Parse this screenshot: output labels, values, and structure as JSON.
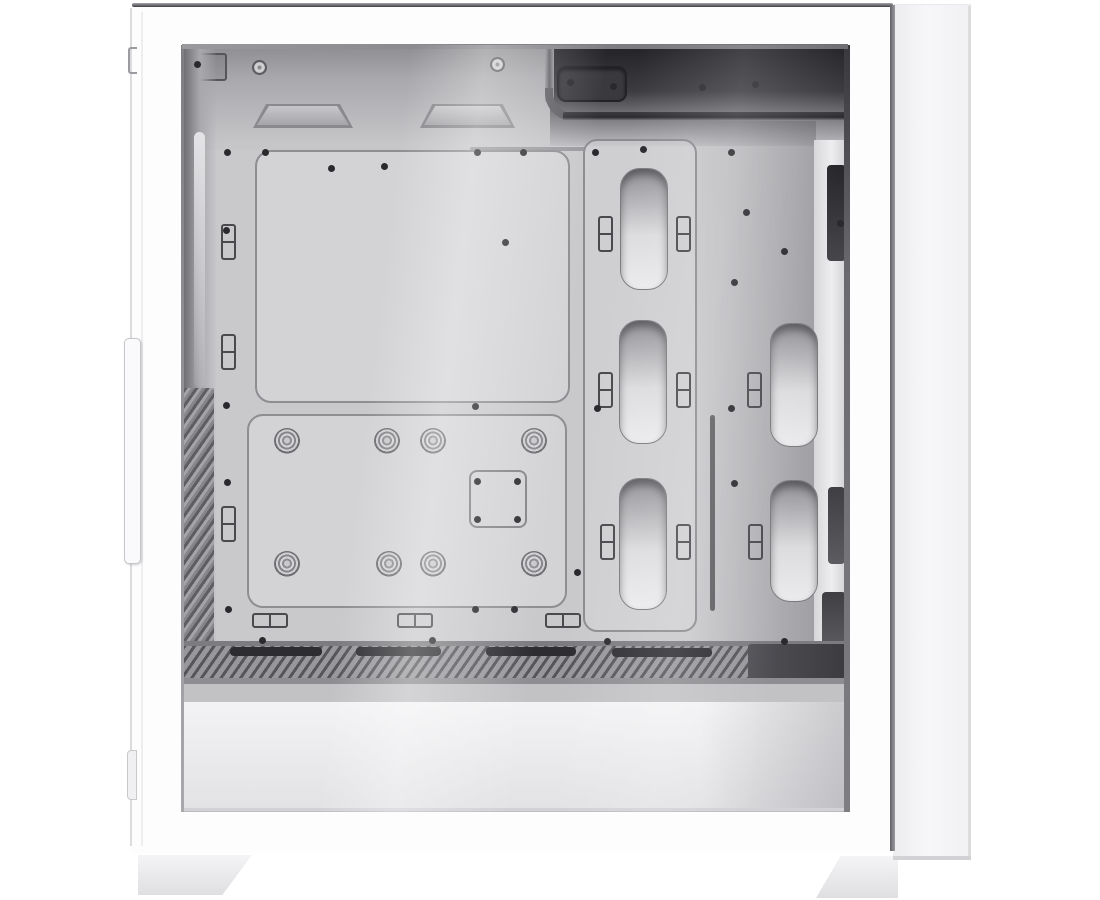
{
  "meta": {
    "label": "White mid-tower PC case, side view product photo with tempered glass panel showing empty interior: motherboard tray with standoffs, cable routing cutouts, PSU shroud with vent, and two white feet",
    "background": "#ffffff"
  },
  "palette": {
    "case_white": "#fdfdfe",
    "interior_gray": "#c9c9cc",
    "top_shadow": "#232327",
    "vent_dark": "#55555a",
    "slot_dark": "#2d2d31",
    "edge_dark": "#3f3f43"
  },
  "parts": [
    {
      "n": "rear-exterior-panel",
      "c": "rear-panel",
      "b": [
        893,
        4,
        78,
        856
      ]
    },
    {
      "n": "rear-panel-right-edge",
      "c": "edge-light",
      "b": [
        968,
        6,
        3,
        850
      ]
    },
    {
      "n": "side-frame",
      "c": "case-body",
      "b": [
        130,
        4,
        765,
        849
      ]
    },
    {
      "n": "case-top-edge",
      "c": "edge-dark-h",
      "b": [
        132,
        3,
        761,
        4
      ]
    },
    {
      "n": "case-right-edge",
      "c": "edge-dark-v",
      "b": [
        890,
        5,
        5,
        846
      ]
    },
    {
      "n": "case-left-edge",
      "c": "edge-light",
      "b": [
        130,
        8,
        2,
        838
      ]
    },
    {
      "n": "front-panel-seam",
      "c": "seam",
      "b": [
        141,
        12,
        2,
        834
      ]
    },
    {
      "n": "tempered-glass",
      "c": "glass",
      "b": [
        182,
        45,
        668,
        767
      ]
    },
    {
      "n": "interior-top-left",
      "c": "band-left",
      "b": [
        183,
        46,
        367,
        104
      ]
    },
    {
      "n": "interior-top-right",
      "c": "band-right",
      "b": [
        550,
        46,
        297,
        100
      ]
    },
    {
      "n": "front-io-bracket",
      "c": "bracket-dark",
      "b": [
        189,
        53,
        38,
        28
      ]
    },
    {
      "n": "thumbscrew",
      "c": "screw-big",
      "b": [
        252,
        60,
        15,
        15
      ]
    },
    {
      "n": "thumbscrew",
      "c": "screw-big",
      "b": [
        490,
        57,
        15,
        15
      ]
    },
    {
      "n": "top-fan-rail",
      "c": "trap-out",
      "b": [
        253,
        104,
        100,
        24
      ]
    },
    {
      "n": "top-fan-rail-face",
      "c": "trap-in",
      "b": [
        257,
        106,
        92,
        19
      ]
    },
    {
      "n": "top-fan-rail",
      "c": "trap-out",
      "b": [
        420,
        104,
        95,
        24
      ]
    },
    {
      "n": "top-fan-rail-face",
      "c": "trap-in",
      "b": [
        424,
        106,
        87,
        19
      ]
    },
    {
      "n": "top-cable-cutout",
      "c": "slot-dark",
      "b": [
        557,
        66,
        70,
        36
      ]
    },
    {
      "n": "cable-channel-line",
      "c": "chan-line",
      "b": [
        470,
        147,
        115,
        4
      ]
    },
    {
      "n": "cable-channel-vertical",
      "c": "tube",
      "b": [
        545,
        44,
        9,
        58
      ]
    },
    {
      "n": "cable-channel-elbow",
      "c": "elbow",
      "b": [
        545,
        88,
        28,
        33
      ]
    },
    {
      "n": "cable-channel-ridge",
      "c": "ridge",
      "b": [
        563,
        112,
        283,
        9
      ]
    },
    {
      "n": "front-interior-column",
      "c": "front-col",
      "b": [
        183,
        46,
        34,
        610
      ]
    },
    {
      "n": "front-column-highlight",
      "c": "strip-light",
      "b": [
        194,
        132,
        11,
        255
      ]
    },
    {
      "n": "front-vent-slats",
      "c": "slats",
      "b": [
        184,
        388,
        30,
        264
      ]
    },
    {
      "n": "rear-shadow",
      "c": "shade-right",
      "b": [
        690,
        121,
        126,
        522
      ]
    },
    {
      "n": "rear-wall-highlight",
      "c": "bright-band",
      "b": [
        814,
        140,
        32,
        503
      ]
    },
    {
      "n": "mb-tray-upper-plate",
      "c": "plate",
      "b": [
        255,
        150,
        315,
        253
      ]
    },
    {
      "n": "mb-tray-lower-plate",
      "c": "plate",
      "b": [
        247,
        414,
        320,
        194
      ]
    },
    {
      "n": "cable-cutout-column",
      "c": "col-outline",
      "b": [
        583,
        139,
        114,
        493
      ]
    },
    {
      "n": "cable-cutout",
      "c": "cutout",
      "b": [
        620,
        168,
        48,
        122
      ]
    },
    {
      "n": "cable-cutout",
      "c": "cutout",
      "b": [
        619,
        320,
        48,
        124
      ]
    },
    {
      "n": "cable-cutout",
      "c": "cutout",
      "b": [
        619,
        478,
        48,
        132
      ]
    },
    {
      "n": "cable-cutout",
      "c": "cutout",
      "b": [
        770,
        323,
        48,
        124
      ]
    },
    {
      "n": "cable-cutout",
      "c": "cutout",
      "b": [
        770,
        480,
        48,
        122
      ]
    },
    {
      "n": "cable-slit",
      "c": "slit",
      "b": [
        710,
        415,
        5,
        196
      ]
    },
    {
      "n": "cpu-cooler-bracket",
      "c": "sq-bracket",
      "b": [
        469,
        470,
        58,
        58
      ]
    },
    {
      "n": "rear-latch-bar",
      "c": "bar-dark",
      "b": [
        827,
        165,
        19,
        96
      ]
    },
    {
      "n": "rear-latch-bar",
      "c": "bar-dark2",
      "b": [
        828,
        487,
        17,
        77
      ]
    },
    {
      "n": "rear-latch-bar",
      "c": "bar-dark2",
      "b": [
        822,
        592,
        24,
        56
      ]
    },
    {
      "n": "shroud-step",
      "c": "step",
      "b": [
        183,
        641,
        663,
        5
      ]
    },
    {
      "n": "psu-shroud-vent",
      "c": "hatch",
      "b": [
        183,
        646,
        663,
        32
      ]
    },
    {
      "n": "shroud-vent-slot",
      "c": "slot-dark2",
      "b": [
        230,
        647,
        92,
        9
      ]
    },
    {
      "n": "shroud-vent-slot",
      "c": "slot-dark2",
      "b": [
        356,
        647,
        85,
        9
      ]
    },
    {
      "n": "shroud-vent-slot",
      "c": "slot-dark2",
      "b": [
        486,
        647,
        90,
        9
      ]
    },
    {
      "n": "shroud-vent-slot",
      "c": "slot-dark2",
      "b": [
        612,
        648,
        100,
        9
      ]
    },
    {
      "n": "shroud-rear-shadow",
      "c": "block-dark",
      "b": [
        748,
        644,
        98,
        34
      ]
    },
    {
      "n": "shroud-under-line",
      "c": "under-line",
      "b": [
        183,
        678,
        663,
        6
      ]
    },
    {
      "n": "shroud-top-band",
      "c": "band-gray",
      "b": [
        183,
        684,
        663,
        18
      ]
    },
    {
      "n": "psu-shroud-face",
      "c": "shroud-face",
      "b": [
        183,
        702,
        663,
        108
      ]
    },
    {
      "n": "shroud-face-shadow",
      "c": "shade-right2",
      "b": [
        700,
        702,
        146,
        108
      ]
    },
    {
      "n": "glass-bottom-edge",
      "c": "edge-light2",
      "b": [
        183,
        808,
        663,
        3
      ]
    },
    {
      "n": "glass-left-edge",
      "c": "glass-edge-l",
      "b": [
        181,
        45,
        3,
        767
      ]
    },
    {
      "n": "glass-right-edge",
      "c": "glass-edge-r",
      "b": [
        844,
        45,
        6,
        767
      ]
    },
    {
      "n": "glass-top-edge",
      "c": "glass-edge-t",
      "b": [
        182,
        44,
        666,
        5
      ]
    },
    {
      "n": "left-foot",
      "c": "foot foot-l",
      "b": [
        138,
        855,
        114,
        40
      ]
    },
    {
      "n": "right-foot",
      "c": "foot foot-r",
      "b": [
        816,
        856,
        82,
        42
      ]
    },
    {
      "n": "rear-panel-bottom-edge",
      "c": "edge-light2",
      "b": [
        893,
        856,
        78,
        4
      ]
    },
    {
      "n": "front-panel-notch",
      "c": "notch",
      "b": [
        128,
        47,
        9,
        27
      ]
    },
    {
      "n": "front-panel-trim",
      "c": "f-plate",
      "b": [
        124,
        338,
        17,
        226
      ]
    },
    {
      "n": "front-panel-tab",
      "c": "f-tab",
      "b": [
        127,
        750,
        10,
        50
      ]
    }
  ],
  "standoffs": [
    [
      287,
      441
    ],
    [
      387,
      441
    ],
    [
      433,
      441
    ],
    [
      534,
      441
    ],
    [
      287,
      564
    ],
    [
      389,
      564
    ],
    [
      433,
      564
    ],
    [
      534,
      564
    ]
  ],
  "cable_ties_v": [
    [
      221,
      224
    ],
    [
      221,
      334
    ],
    [
      221,
      506
    ],
    [
      598,
      216
    ],
    [
      676,
      216
    ],
    [
      598,
      372
    ],
    [
      676,
      372
    ],
    [
      747,
      372
    ],
    [
      600,
      524
    ],
    [
      676,
      524
    ],
    [
      748,
      524
    ]
  ],
  "cable_ties_h": [
    [
      252,
      613
    ],
    [
      397,
      613
    ],
    [
      545,
      613
    ]
  ],
  "screw_dots": [
    [
      197,
      64
    ],
    [
      570,
      82
    ],
    [
      613,
      86
    ],
    [
      702,
      87
    ],
    [
      755,
      84
    ],
    [
      227,
      152
    ],
    [
      265,
      152
    ],
    [
      477,
      152
    ],
    [
      523,
      152
    ],
    [
      331,
      168
    ],
    [
      384,
      166
    ],
    [
      595,
      152
    ],
    [
      643,
      149
    ],
    [
      731,
      152
    ],
    [
      226,
      230
    ],
    [
      226,
      405
    ],
    [
      227,
      482
    ],
    [
      228,
      609
    ],
    [
      505,
      242
    ],
    [
      746,
      212
    ],
    [
      784,
      251
    ],
    [
      734,
      282
    ],
    [
      731,
      408
    ],
    [
      840,
      223
    ],
    [
      734,
      483
    ],
    [
      577,
      572
    ],
    [
      475,
      406
    ],
    [
      597,
      408
    ],
    [
      475,
      609
    ],
    [
      514,
      609
    ],
    [
      477,
      481
    ],
    [
      517,
      481
    ],
    [
      477,
      519
    ],
    [
      517,
      519
    ],
    [
      262,
      640
    ],
    [
      432,
      640
    ],
    [
      607,
      641
    ],
    [
      784,
      641
    ]
  ],
  "repeat": [
    {
      "list": "standoffs",
      "name": "motherboard-standoff",
      "cls": "standoff",
      "w": 26,
      "h": 26,
      "center": true
    },
    {
      "list": "cable_ties_v",
      "name": "cable-tie-point",
      "cls": "tie-v",
      "w": 15,
      "h": 36,
      "center": false
    },
    {
      "list": "cable_ties_h",
      "name": "cable-tie-point",
      "cls": "tie-h",
      "w": 36,
      "h": 15,
      "center": false
    },
    {
      "list": "screw_dots",
      "name": "screw-hole",
      "cls": "dot",
      "w": 7,
      "h": 7,
      "center": true
    }
  ],
  "overlays": [
    {
      "n": "glass-reflection",
      "c": "refl1",
      "b": [
        182,
        45,
        668,
        767
      ]
    },
    {
      "n": "glass-reflection",
      "c": "refl2",
      "b": [
        182,
        45,
        668,
        767
      ]
    }
  ]
}
